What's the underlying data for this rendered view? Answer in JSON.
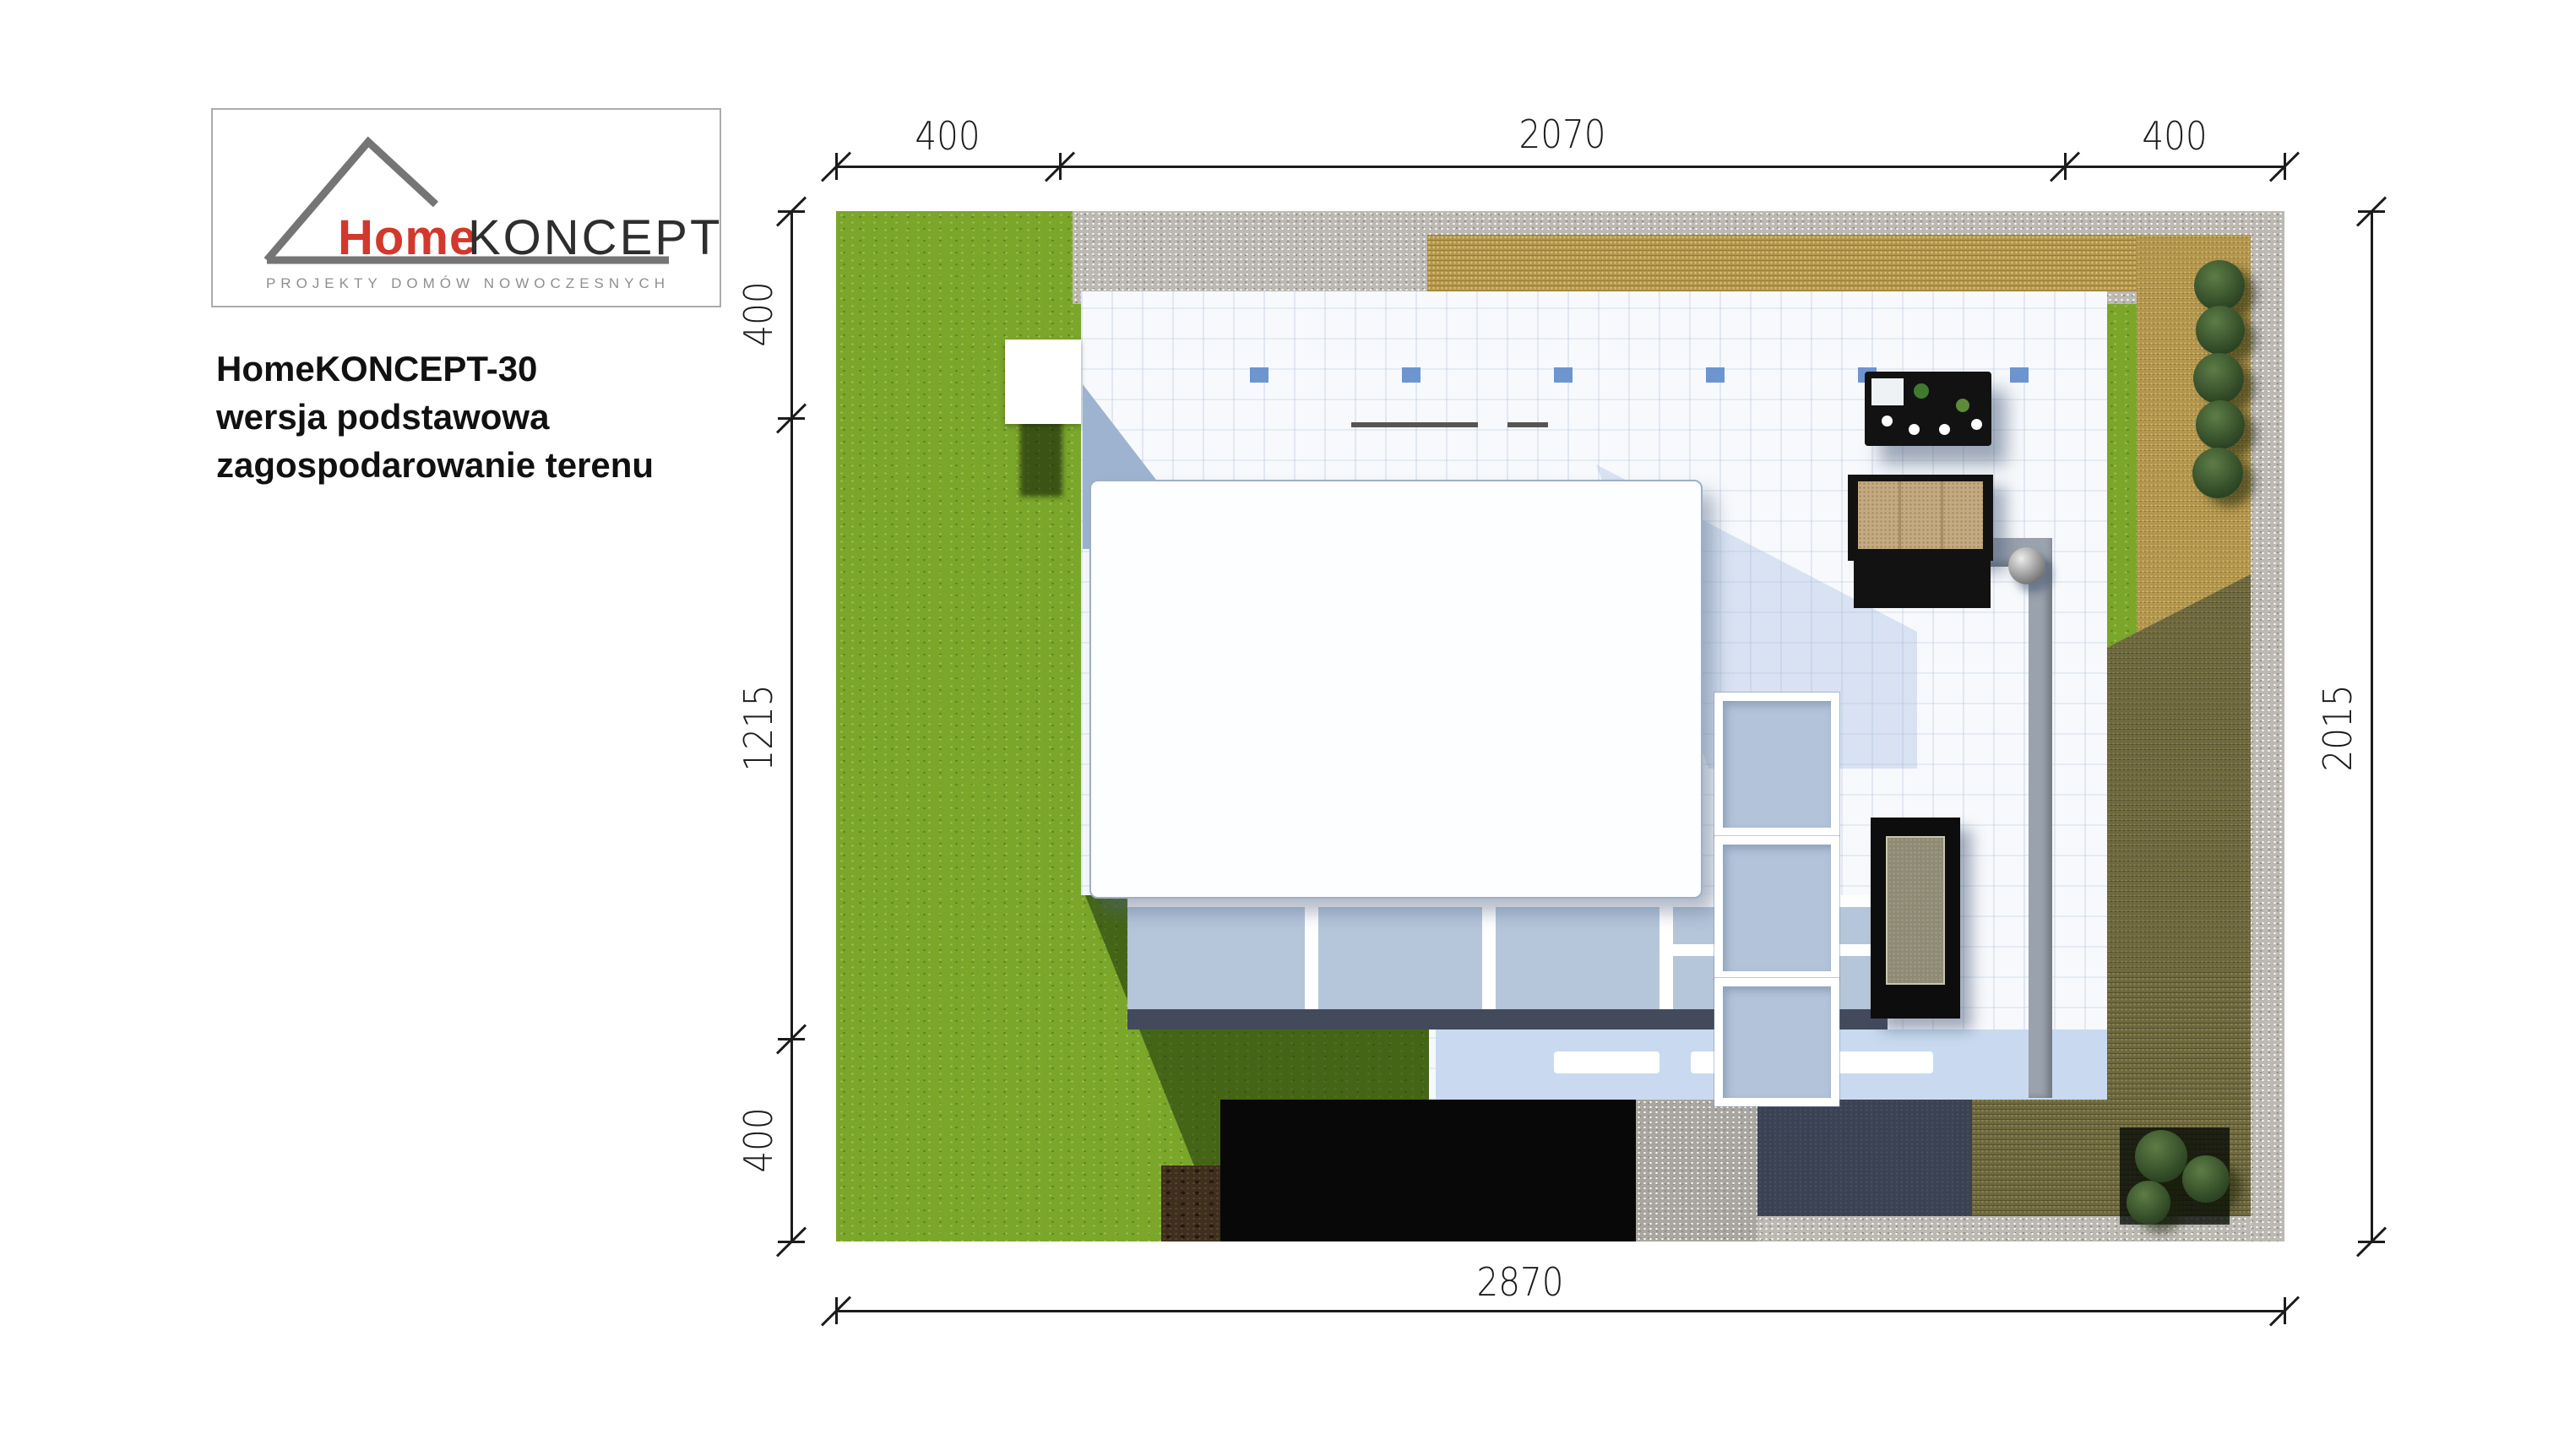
{
  "logo": {
    "home": "Home",
    "koncept": "KONCEPT",
    "tagline": "PROJEKTY DOMÓW NOWOCZESNYCH"
  },
  "title": {
    "line1": "HomeKONCEPT-30",
    "line2": "wersja podstawowa",
    "line3": "zagospodarowanie terenu"
  },
  "dimensions": {
    "top": [
      "400",
      "2070",
      "400"
    ],
    "left": [
      "400",
      "1215",
      "400"
    ],
    "right": [
      "2015"
    ],
    "bottom": [
      "2870"
    ]
  },
  "colors": {
    "grass": "#7aa62a",
    "gravel": "#bcb9b3",
    "paver_tan": "#b2954e",
    "paver_olive": "#6e6840",
    "driveway_navy": "#3b4254",
    "terrace_white": "#f7f9fc",
    "deck_blue": "#b5c5da",
    "fascia_dark": "#424a5c",
    "roof_white": "#fdfeff",
    "skylight_blue": "#6d95cf",
    "sofa_tan": "#c3aa80",
    "furniture_black": "#121212",
    "bush_green": "#2c4423",
    "dim_line": "#1c1c1c",
    "logo_red": "#d2382c",
    "text_dark": "#111111"
  }
}
